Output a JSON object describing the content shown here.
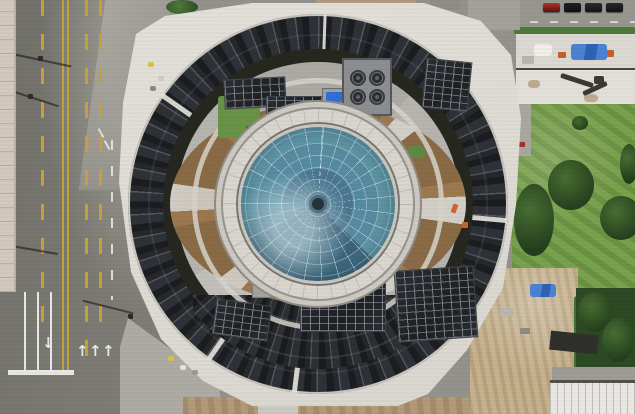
{
  "scene": {
    "description": "Aerial drone photo, top-down view of a circular building with a central glass dome skylight, a ring of dark rooftop solar panels, radial brown planter gardens around the dome, rooftop HVAC equipment, a multi-lane road on the left, parked cars and a construction staging rooftop at top right, green lawn with trees on the right, and a sandy construction yard at bottom right",
    "width": 635,
    "height": 414
  },
  "palette": {
    "lane-yellow": "#c9a13c",
    "lane-white": "#e9e9e4",
    "roof": "#b6b4ae",
    "lawn": "#7aa24d",
    "dirt": "#c7b28e",
    "staging": "#dcd9d2",
    "hedge": "#4c7b38",
    "canopy": "#e9e8e4",
    "tank-blue": "#2f6fd6",
    "dome-deep": "#3f6a85",
    "dome-mid": "#578ba0",
    "dome-teal": "#67a0ad"
  },
  "road": {
    "lane_arrows": [
      {
        "glyph": "↓",
        "x": 42,
        "y": 336
      },
      {
        "glyph": "↑",
        "x": 76,
        "y": 344
      },
      {
        "glyph": "↑",
        "x": 89,
        "y": 344
      },
      {
        "glyph": "↑",
        "x": 102,
        "y": 344
      }
    ]
  },
  "right_strip": {
    "parked_cars": [
      "#b92f2a",
      "#1f2124",
      "#2a2d31",
      "#26292c"
    ]
  },
  "building": {
    "hvac_fan_count": 4
  }
}
